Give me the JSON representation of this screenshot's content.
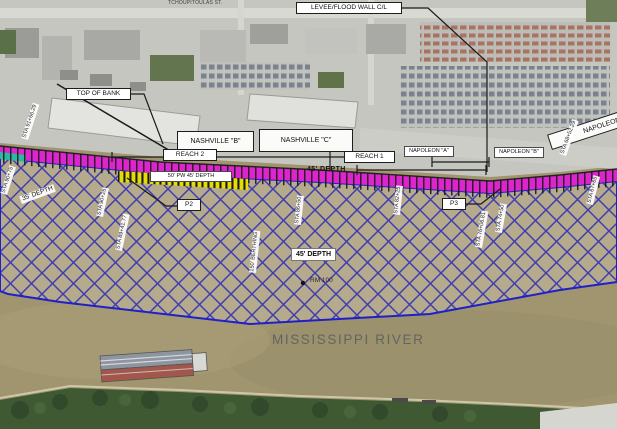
{
  "map": {
    "title": "Mississippi River wharf dredging plan overlay",
    "annotations": [
      {
        "id": "tchoupitoulas-street-label",
        "text": "TCHOUPITOULAS ST.",
        "x": 168,
        "y": 0,
        "cls": "street"
      },
      {
        "id": "levee-flood-wall-label",
        "text": "LEVEE/FLOOD WALL C/L",
        "x": 296,
        "y": 2,
        "w": 100,
        "cls": "box"
      },
      {
        "id": "top-of-bank-label",
        "text": "TOP OF BANK",
        "x": 66,
        "y": 88,
        "w": 59,
        "cls": "box"
      },
      {
        "id": "nashville-b-label",
        "text": "NASHVILLE \"B\"",
        "x": 177,
        "y": 131,
        "w": 77,
        "h": 21,
        "cls": "boxlg"
      },
      {
        "id": "nashville-c-label",
        "text": "NASHVILLE \"C\"",
        "x": 259,
        "y": 129,
        "w": 94,
        "h": 23,
        "cls": "boxlg"
      },
      {
        "id": "reach-2-label",
        "text": "REACH 2",
        "x": 163,
        "y": 149,
        "w": 48,
        "cls": "box"
      },
      {
        "id": "reach-1-label",
        "text": "REACH 1",
        "x": 344,
        "y": 151,
        "w": 45,
        "cls": "box"
      },
      {
        "id": "napoleon-a-label",
        "text": "NAPOLEON \"A\"",
        "x": 404,
        "y": 146,
        "w": 48,
        "cls": "boxsm"
      },
      {
        "id": "napoleon-b-label",
        "text": "NAPOLEON \"B\"",
        "x": 494,
        "y": 147,
        "w": 48,
        "cls": "boxsm"
      },
      {
        "id": "napoleon-wharf-label",
        "text": "NAPOLEON",
        "x": 552,
        "y": 134,
        "w": 110,
        "h": 16,
        "rot": -18,
        "cls": "boxlg"
      },
      {
        "id": "berthing-depth-label",
        "text": "50' PW 45' DEPTH",
        "x": 150,
        "y": 171,
        "w": 80,
        "cls": "boxsm"
      },
      {
        "id": "band-depth-45-label",
        "text": "45' DEPTH",
        "x": 307,
        "y": 166,
        "cls": "bandtext"
      },
      {
        "id": "depth-35-label",
        "text": "35' DEPTH",
        "x": 22,
        "y": 196,
        "rot": -20,
        "cls": "strip35"
      },
      {
        "id": "depth-45-label",
        "text": "45' DEPTH",
        "x": 291,
        "y": 248,
        "w": 43,
        "cls": "depthbox"
      },
      {
        "id": "rm-100-label",
        "text": "RM 100",
        "x": 310,
        "y": 277,
        "cls": "rm"
      },
      {
        "id": "p2-label",
        "text": "P2",
        "x": 177,
        "y": 199,
        "w": 18,
        "cls": "box"
      },
      {
        "id": "p3-label",
        "text": "P3",
        "x": 442,
        "y": 198,
        "w": 18,
        "cls": "box"
      },
      {
        "id": "mississippi-river-label",
        "text": "MISSISSIPPI RIVER",
        "x": 272,
        "y": 332,
        "cls": "river"
      },
      {
        "id": "sta-91-66-label",
        "text": "STA 91+66.29",
        "x": 28,
        "y": 133,
        "rot": -72,
        "cls": "vstrip"
      },
      {
        "id": "sta-90-75-label",
        "text": "STA 90+75",
        "x": 7,
        "y": 188,
        "rot": -72,
        "cls": "vstrip"
      },
      {
        "id": "sta-90-25-label",
        "text": "STA 90+25",
        "x": 103,
        "y": 210,
        "rot": -78,
        "cls": "vstrip"
      },
      {
        "id": "sta-89-41-label",
        "text": "STA 89+41.77",
        "x": 122,
        "y": 244,
        "rot": -78,
        "cls": "vstrip"
      },
      {
        "id": "berthing-150-label",
        "text": "150' BERTHING",
        "x": 256,
        "y": 266,
        "rot": -84,
        "cls": "vstrip"
      },
      {
        "id": "sta-86-50-label",
        "text": "STA 86+50",
        "x": 301,
        "y": 218,
        "rot": -84,
        "cls": "vstrip"
      },
      {
        "id": "sta-82-25-label",
        "text": "STA 82+25",
        "x": 400,
        "y": 208,
        "rot": -84,
        "cls": "vstrip"
      },
      {
        "id": "sta-76-06-label",
        "text": "STA 76+06.81",
        "x": 482,
        "y": 241,
        "rot": -80,
        "cls": "vstrip"
      },
      {
        "id": "sta-74-50-label",
        "text": "STA 74+50",
        "x": 502,
        "y": 226,
        "rot": -80,
        "cls": "vstrip"
      },
      {
        "id": "sta-68-52-label",
        "text": "STA 68+52.29",
        "x": 566,
        "y": 149,
        "rot": -70,
        "cls": "vstrip"
      },
      {
        "id": "sta-67-65-label",
        "text": "STA 67+65",
        "x": 593,
        "y": 198,
        "rot": -76,
        "cls": "vstrip"
      }
    ]
  },
  "colors": {
    "dredge_band_magenta": "#dc25cc",
    "hatch_blue": "#2a2ab8",
    "berthing_yellow": "#e6dd00",
    "river_tan": "#a0956f",
    "hatch_area_tan": "#b5aa8b",
    "urban_gray": "#c6c6c1",
    "vegetation_green": "#3f5a33"
  }
}
